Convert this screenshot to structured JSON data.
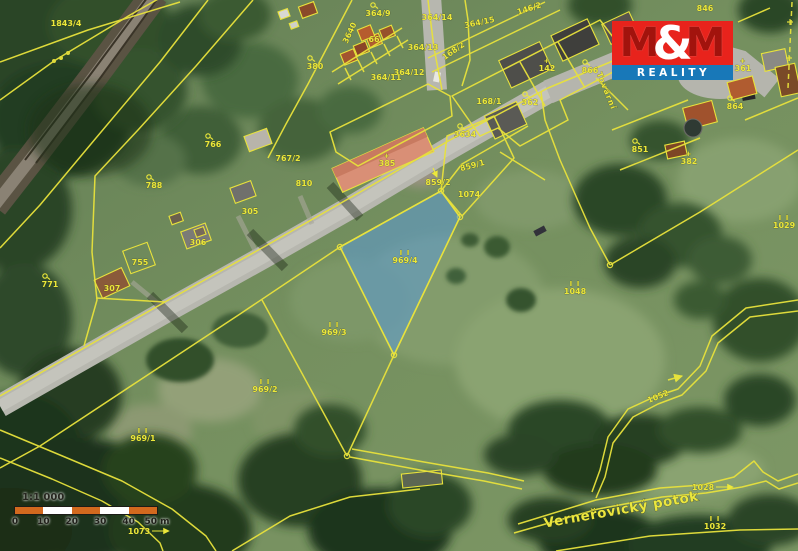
{
  "map": {
    "highlighted_parcel": "969/4",
    "colors": {
      "cadastre_yellow": "#ece83a",
      "highlight_blue": "#5b9bd5",
      "road_gray": "#b7b7af",
      "meadow_green": "#6f8a5e"
    },
    "water_label": {
      "t": "Verneřovický potok",
      "x": 622,
      "y": 514,
      "r": -10
    },
    "street_label": {
      "t": "Tovární",
      "x": 604,
      "y": 92,
      "r": 68
    },
    "parcel_labels": [
      {
        "t": "1843/4",
        "x": 66,
        "y": 26
      },
      {
        "t": "766",
        "x": 213,
        "y": 147,
        "s": "c"
      },
      {
        "t": "788",
        "x": 154,
        "y": 188,
        "s": "c"
      },
      {
        "t": "767/2",
        "x": 288,
        "y": 161
      },
      {
        "t": "810",
        "x": 304,
        "y": 186
      },
      {
        "t": "305",
        "x": 250,
        "y": 214
      },
      {
        "t": "306",
        "x": 198,
        "y": 245
      },
      {
        "t": "307",
        "x": 112,
        "y": 291
      },
      {
        "t": "755",
        "x": 140,
        "y": 265
      },
      {
        "t": "771",
        "x": 50,
        "y": 287,
        "s": "c"
      },
      {
        "t": "380",
        "x": 315,
        "y": 69,
        "s": "c"
      },
      {
        "t": "3640",
        "x": 352,
        "y": 34,
        "r": -65
      },
      {
        "t": "364/9",
        "x": 378,
        "y": 16,
        "s": "c"
      },
      {
        "t": "66",
        "x": 374,
        "y": 42
      },
      {
        "t": "364/11",
        "x": 386,
        "y": 80
      },
      {
        "t": "364/12",
        "x": 409,
        "y": 75
      },
      {
        "t": "364/13",
        "x": 423,
        "y": 50
      },
      {
        "t": "364/14",
        "x": 437,
        "y": 20
      },
      {
        "t": "364/15",
        "x": 480,
        "y": 25,
        "r": -12
      },
      {
        "t": "146/2",
        "x": 530,
        "y": 11,
        "r": -18
      },
      {
        "t": "168/2",
        "x": 455,
        "y": 53,
        "r": -35
      },
      {
        "t": "168/1",
        "x": 489,
        "y": 104
      },
      {
        "t": "142",
        "x": 547,
        "y": 71,
        "s": "+"
      },
      {
        "t": "362",
        "x": 530,
        "y": 105,
        "s": "c"
      },
      {
        "t": "866",
        "x": 590,
        "y": 73,
        "s": "c"
      },
      {
        "t": "846",
        "x": 705,
        "y": 11
      },
      {
        "t": "361",
        "x": 743,
        "y": 71,
        "s": "+"
      },
      {
        "t": "864",
        "x": 735,
        "y": 109,
        "s": "c"
      },
      {
        "t": "851",
        "x": 640,
        "y": 152,
        "s": "c"
      },
      {
        "t": "382",
        "x": 689,
        "y": 164,
        "s": "+"
      },
      {
        "t": "385",
        "x": 387,
        "y": 166,
        "s": "+"
      },
      {
        "t": "3634",
        "x": 465,
        "y": 137,
        "s": "c"
      },
      {
        "t": "859/1",
        "x": 473,
        "y": 168,
        "r": -15
      },
      {
        "t": "859/2",
        "x": 438,
        "y": 185,
        "s": "v"
      },
      {
        "t": "1074",
        "x": 469,
        "y": 197
      },
      {
        "t": "969/4",
        "x": 405,
        "y": 263,
        "s": "g"
      },
      {
        "t": "1048",
        "x": 575,
        "y": 294,
        "s": "g"
      },
      {
        "t": "969/3",
        "x": 334,
        "y": 335,
        "s": "g"
      },
      {
        "t": "969/2",
        "x": 265,
        "y": 392,
        "s": "g"
      },
      {
        "t": "969/1",
        "x": 143,
        "y": 441,
        "s": "g"
      },
      {
        "t": "1029",
        "x": 784,
        "y": 228,
        "s": "g"
      },
      {
        "t": "1052",
        "x": 659,
        "y": 399,
        "r": -22
      },
      {
        "t": "1028",
        "x": 703,
        "y": 490,
        "s": ">"
      },
      {
        "t": "1032",
        "x": 715,
        "y": 529,
        "s": "g"
      },
      {
        "t": "1073",
        "x": 139,
        "y": 534,
        "s": ">"
      }
    ]
  },
  "logo": {
    "m_left": "M",
    "ampersand": "&",
    "m_right": "M",
    "reality": "REALITY",
    "red": "#e8231c",
    "blue": "#1878b8"
  },
  "scale_bar": {
    "ratio_label": "1:1 000",
    "tick_labels": [
      "0",
      "10",
      "20",
      "30",
      "40",
      "50 m"
    ],
    "segment_colors": [
      "#d2691e",
      "#ffffff",
      "#d2691e",
      "#ffffff",
      "#d2691e"
    ]
  }
}
